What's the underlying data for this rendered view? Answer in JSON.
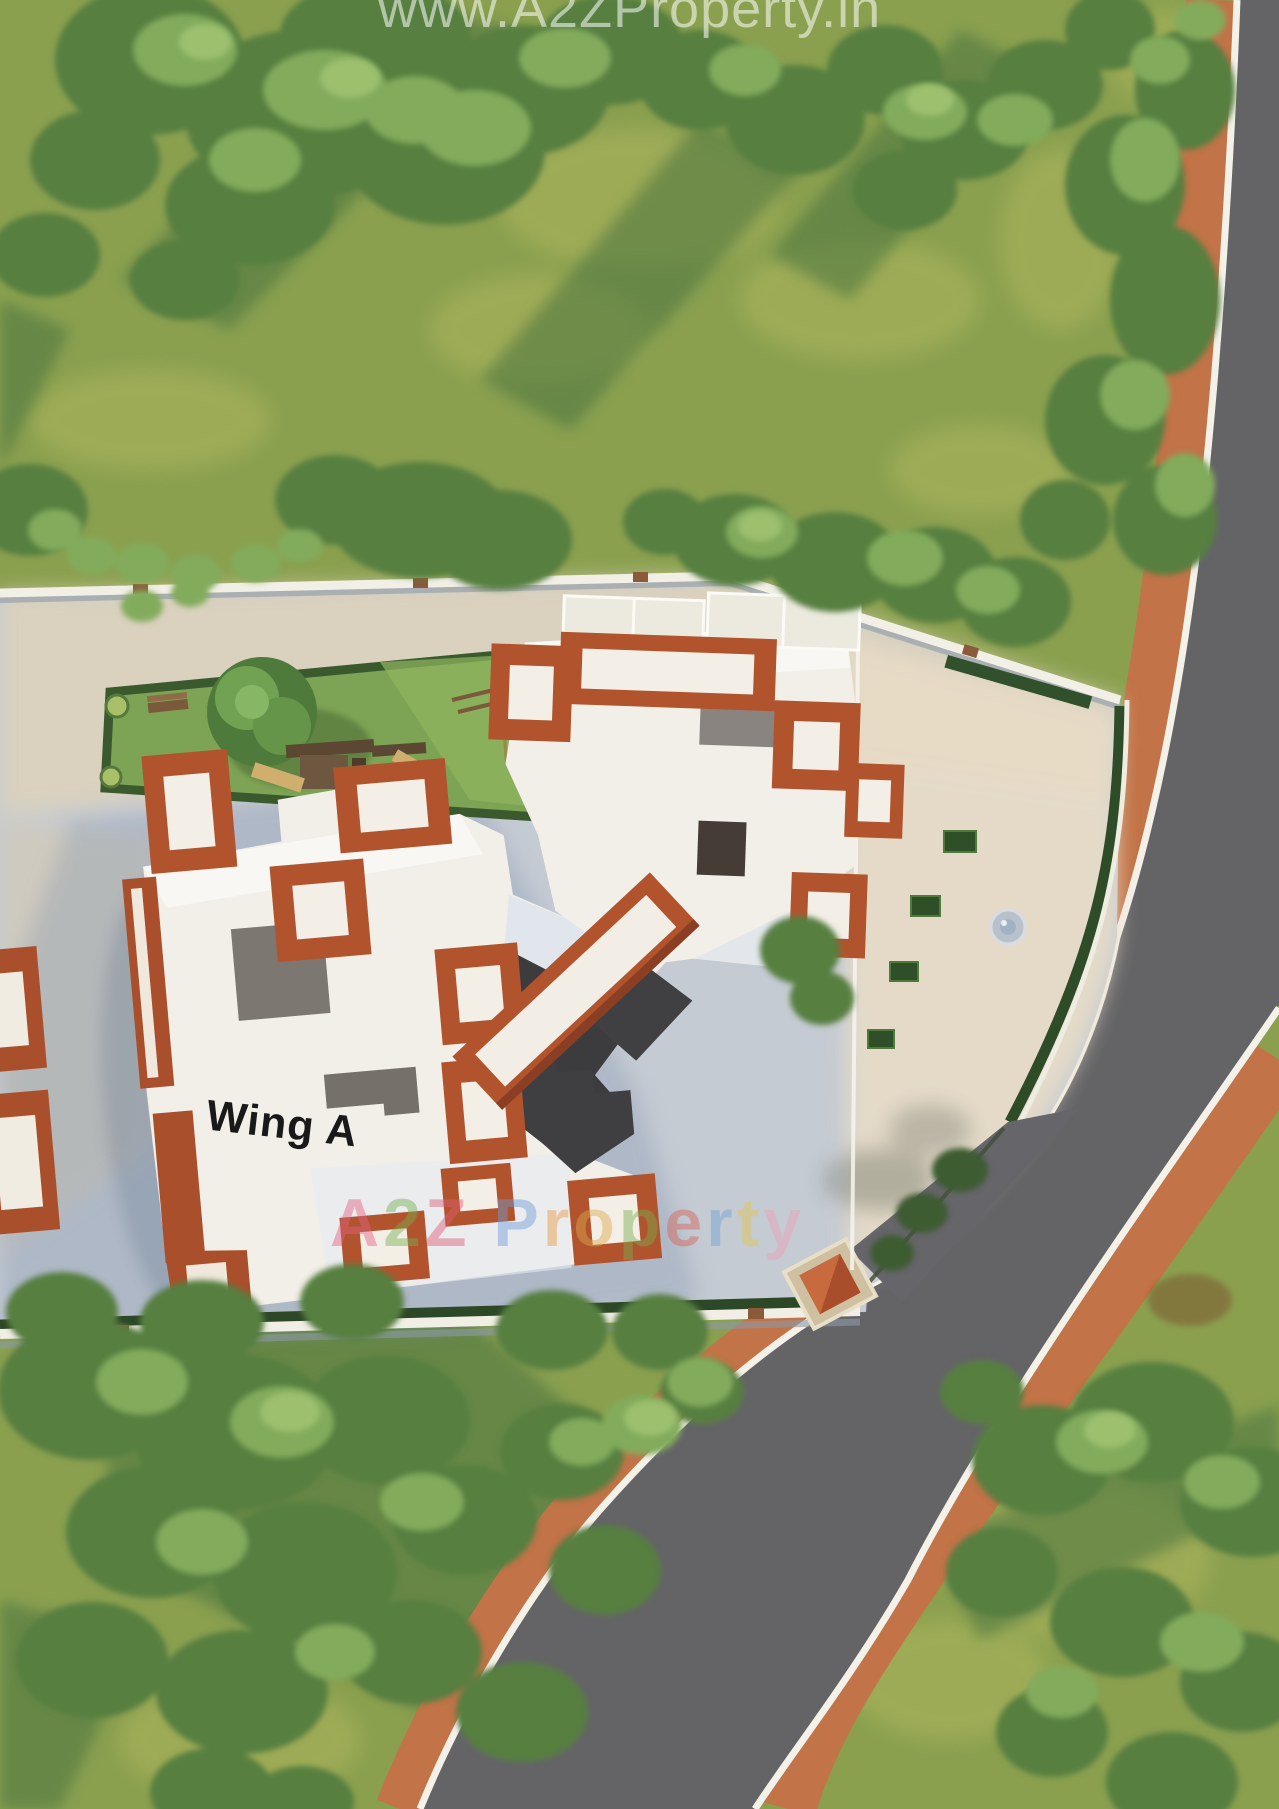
{
  "watermarks": {
    "top_url": "www.A2ZProperty.in",
    "brand_letters": [
      {
        "ch": "A",
        "color": "#e56286"
      },
      {
        "ch": "2",
        "color": "#74b04f"
      },
      {
        "ch": "Z",
        "color": "#e05c74"
      },
      {
        "ch": " ",
        "color": "#ffffff"
      },
      {
        "ch": "P",
        "color": "#6f9bd8"
      },
      {
        "ch": "r",
        "color": "#eb9a3f"
      },
      {
        "ch": "o",
        "color": "#d9a84a"
      },
      {
        "ch": "p",
        "color": "#79ad4f"
      },
      {
        "ch": "e",
        "color": "#da5f52"
      },
      {
        "ch": "r",
        "color": "#6fa3d4"
      },
      {
        "ch": "t",
        "color": "#e3c44e"
      },
      {
        "ch": "y",
        "color": "#ee9fb5"
      }
    ]
  },
  "labels": {
    "wing_a": "Wing A"
  },
  "palette": {
    "grass": "#8aa04f",
    "grass_light": "#a2ae58",
    "grass_shadow": "#4a7340",
    "tree_dark": "#567f41",
    "tree_light": "#82ab5c",
    "tree_accent": "#9cc06e",
    "road": "#646467",
    "sidewalk": "#c27347",
    "curb": "#f4f1e9",
    "pavement": "#c5cbd3",
    "pavement_beige": "#e8dcc6",
    "building_white": "#f2efe8",
    "roof_terracotta": "#b1542e",
    "roof_terracotta_dark": "#8a3e23",
    "shadow_charcoal": "#3c3b3e",
    "hedge": "#2f4c28",
    "lawn": "#7da455",
    "wood": "#6e5740",
    "slide_tan": "#cfae6e"
  }
}
